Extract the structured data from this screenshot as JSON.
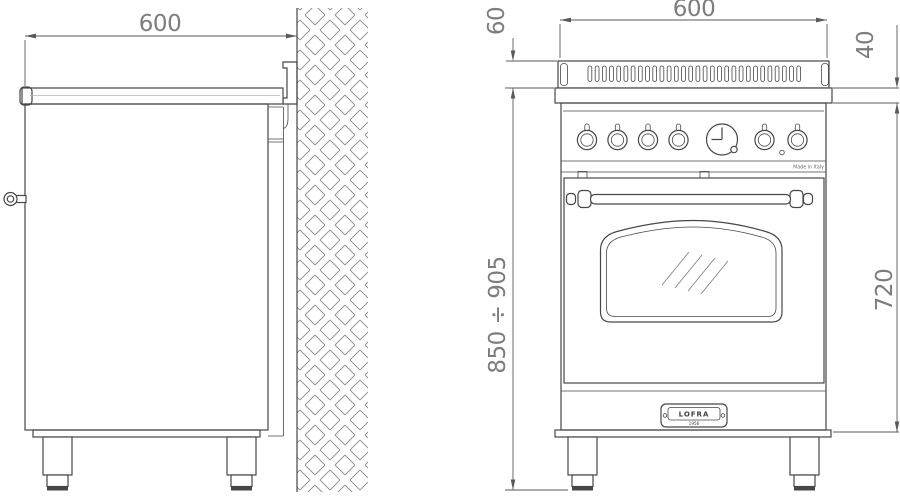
{
  "drawing": {
    "side_view": {
      "top_width": "600"
    },
    "front_view": {
      "top_width": "600",
      "backguard_height": "60",
      "worktop_edge_height": "40",
      "overall_height_range": "850 ÷ 905",
      "body_height": "720",
      "made_in": "Made in Italy",
      "badge_brand": "LOFRA",
      "badge_year": "1956"
    },
    "colors": {
      "background": "#ffffff",
      "line": "#474747",
      "dim_line": "#5a5a5a",
      "dim_text": "#7d7d7d",
      "hatch": "#8f8f8f"
    }
  }
}
